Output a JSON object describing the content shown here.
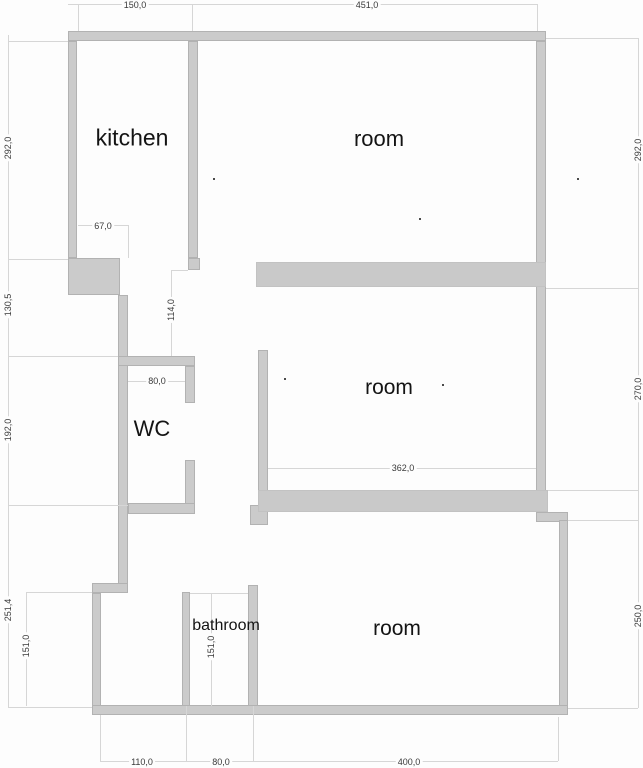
{
  "plan_title": "apartment floor plan",
  "rooms": {
    "kitchen": "kitchen",
    "room_top": "room",
    "wc": "WC",
    "room_middle": "room",
    "bathroom": "bathroom",
    "room_bottom": "room"
  },
  "dims": {
    "top_kitchen_width": "150,0",
    "top_room_width": "451,0",
    "left_kitchen_height": "292,0",
    "left_mid_height": "130,5",
    "left_wc_height": "192,0",
    "left_lower_height": "251,4",
    "left_lowerroom_height": "151,0",
    "right_top_height": "292,0",
    "right_middle_height": "270,0",
    "right_bottom_height": "250,0",
    "bottom_left_width": "110,0",
    "bottom_bathroom_width": "80,0",
    "bottom_room_width": "400,0",
    "kitchen_opening_width": "67,0",
    "hall_opening_height": "114,0",
    "wc_width": "80,0",
    "room_middle_width": "362,0",
    "bathroom_height": "151,0"
  },
  "colors": {
    "wall_fill": "#cbcbcb",
    "wall_border": "#b2b2b2",
    "dimension_line": "#d6d6d6",
    "text": "#141414",
    "background": "#fdfdfd"
  }
}
